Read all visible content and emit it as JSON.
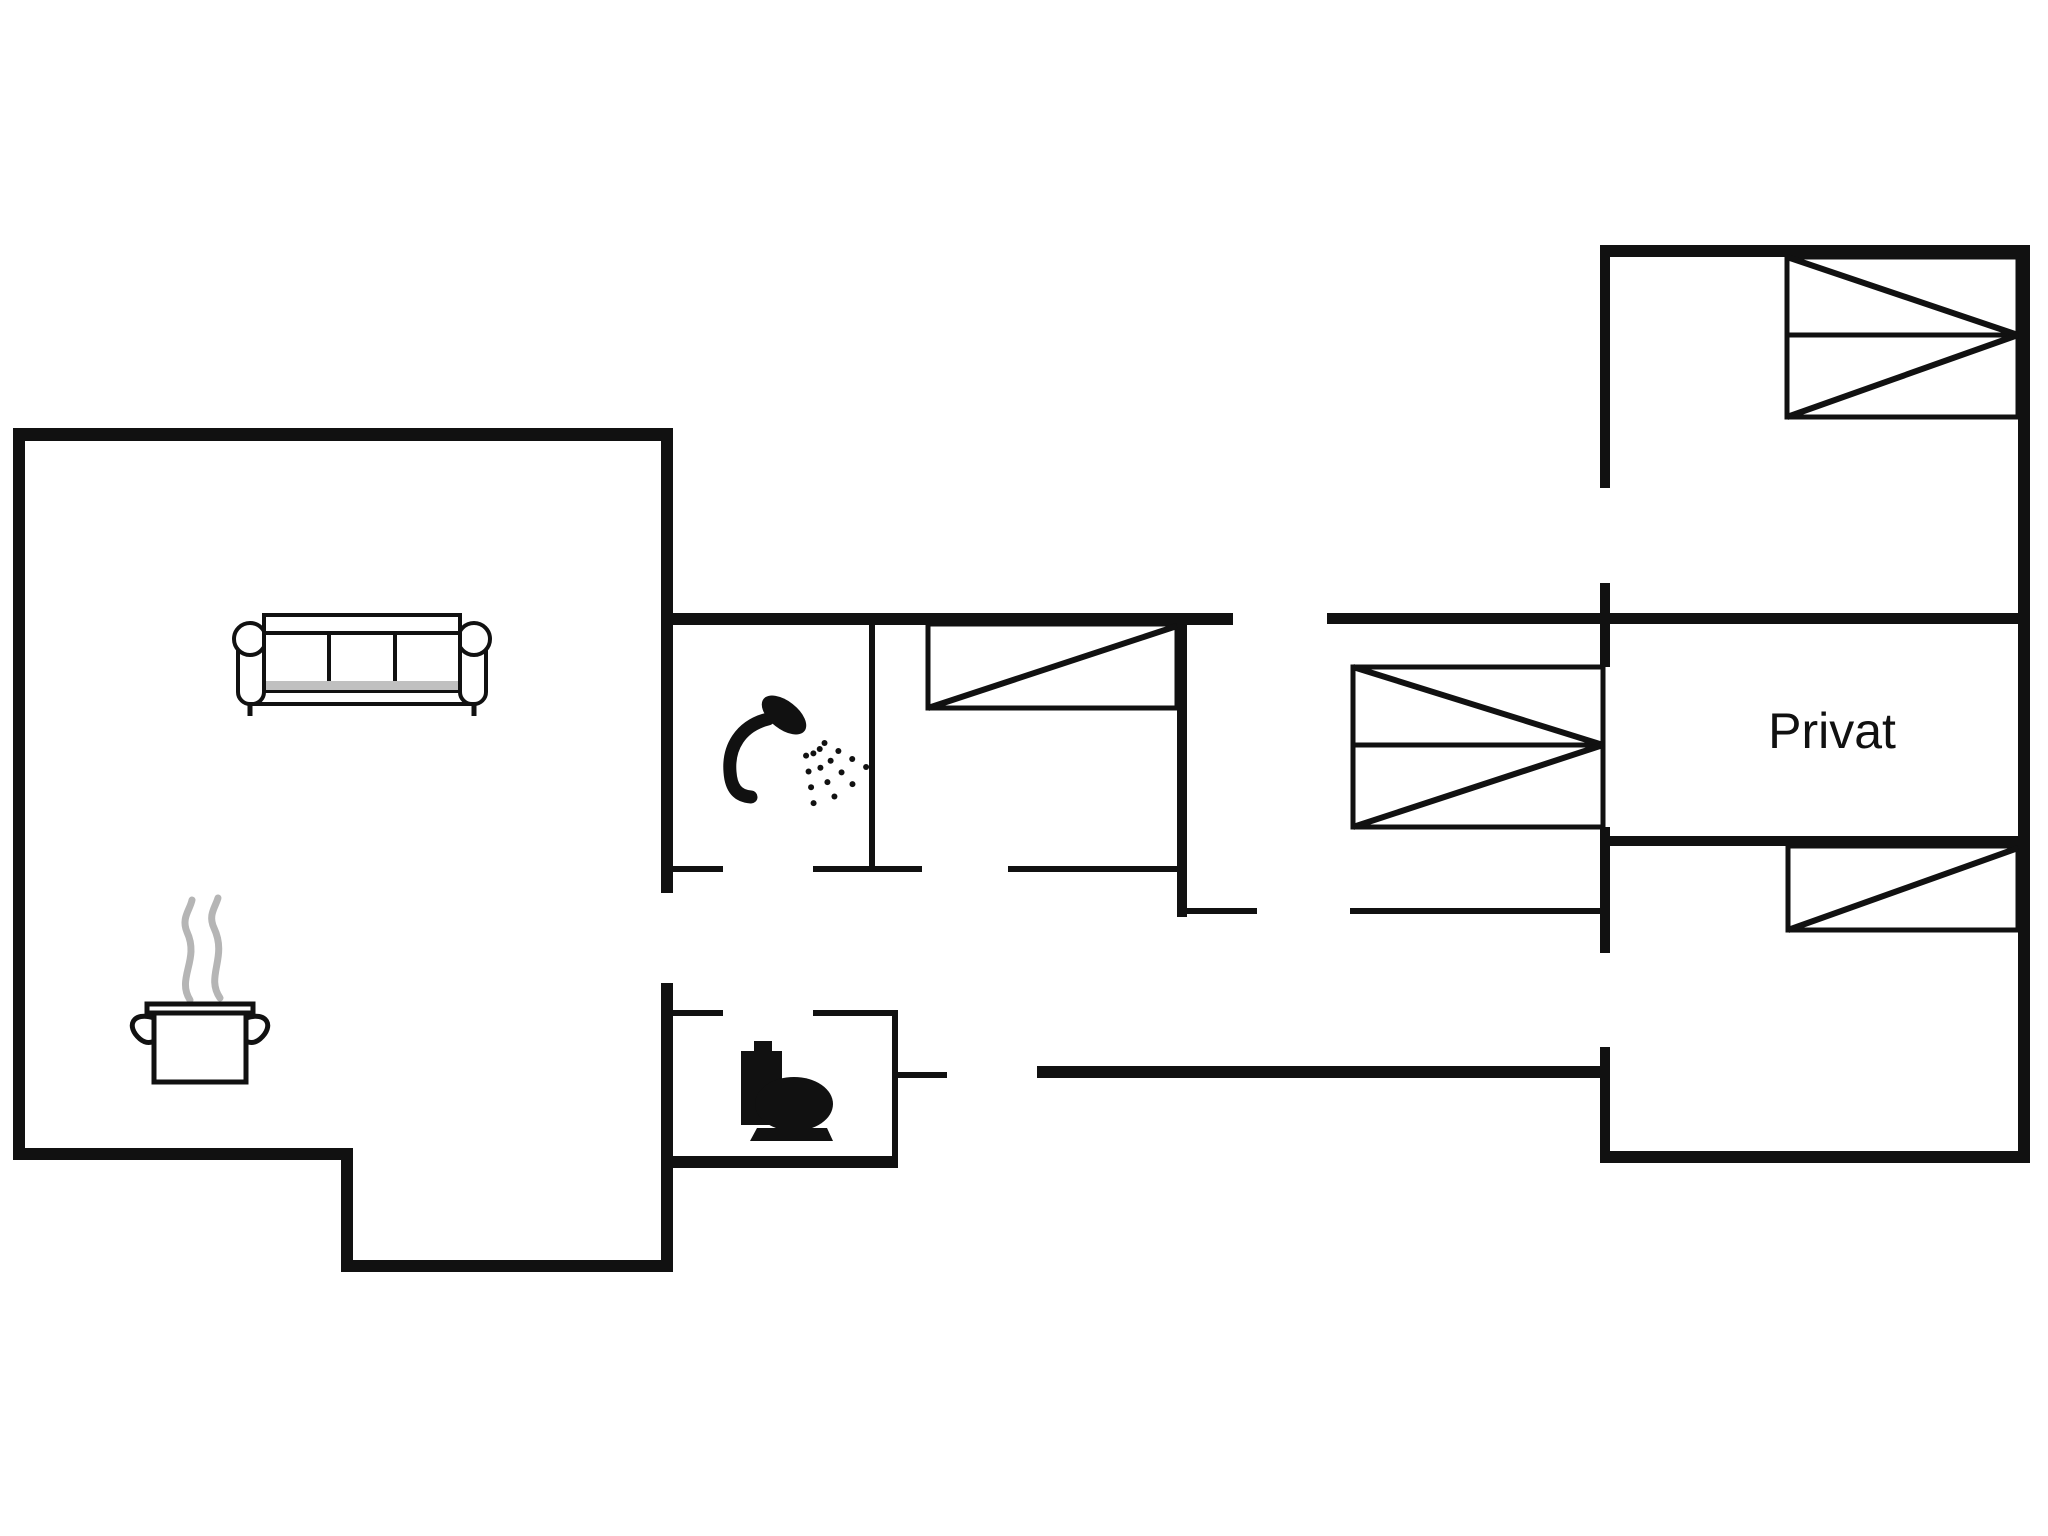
{
  "floorplan": {
    "canvas": {
      "width": 2048,
      "height": 1536,
      "background": "#ffffff"
    },
    "wall_color": "#111111",
    "steam_color": "#b5b5b5",
    "sofa_strip_color": "#c0c0c0",
    "label": {
      "text": "Privat",
      "x": 1832,
      "y": 748,
      "font_size": 50,
      "color": "#111111"
    },
    "walls": [
      {
        "x": 13,
        "y": 428,
        "w": 660,
        "h": 13
      },
      {
        "x": 13,
        "y": 428,
        "w": 12,
        "h": 732
      },
      {
        "x": 13,
        "y": 1148,
        "w": 340,
        "h": 12
      },
      {
        "x": 341,
        "y": 1148,
        "w": 12,
        "h": 124
      },
      {
        "x": 341,
        "y": 1260,
        "w": 332,
        "h": 12
      },
      {
        "x": 661,
        "y": 428,
        "w": 12,
        "h": 465
      },
      {
        "x": 661,
        "y": 983,
        "w": 12,
        "h": 289
      },
      {
        "x": 661,
        "y": 1010,
        "w": 62,
        "h": 6
      },
      {
        "x": 813,
        "y": 1010,
        "w": 85,
        "h": 6
      },
      {
        "x": 892,
        "y": 1010,
        "w": 6,
        "h": 158
      },
      {
        "x": 892,
        "y": 1072,
        "w": 55,
        "h": 6
      },
      {
        "x": 661,
        "y": 1156,
        "w": 237,
        "h": 12
      },
      {
        "x": 661,
        "y": 613,
        "w": 572,
        "h": 12
      },
      {
        "x": 1327,
        "y": 613,
        "w": 703,
        "h": 11
      },
      {
        "x": 869,
        "y": 613,
        "w": 6,
        "h": 259
      },
      {
        "x": 1177,
        "y": 613,
        "w": 10,
        "h": 304
      },
      {
        "x": 661,
        "y": 866,
        "w": 62,
        "h": 6
      },
      {
        "x": 813,
        "y": 866,
        "w": 109,
        "h": 6
      },
      {
        "x": 1008,
        "y": 866,
        "w": 175,
        "h": 6
      },
      {
        "x": 1177,
        "y": 908,
        "w": 80,
        "h": 6
      },
      {
        "x": 1350,
        "y": 908,
        "w": 256,
        "h": 6
      },
      {
        "x": 1037,
        "y": 1066,
        "w": 569,
        "h": 12
      },
      {
        "x": 1600,
        "y": 245,
        "w": 430,
        "h": 12
      },
      {
        "x": 2018,
        "y": 245,
        "w": 12,
        "h": 918
      },
      {
        "x": 1600,
        "y": 1151,
        "w": 430,
        "h": 12
      },
      {
        "x": 1600,
        "y": 245,
        "w": 10,
        "h": 243
      },
      {
        "x": 1600,
        "y": 583,
        "w": 10,
        "h": 84
      },
      {
        "x": 1600,
        "y": 827,
        "w": 10,
        "h": 126
      },
      {
        "x": 1600,
        "y": 1047,
        "w": 10,
        "h": 116
      },
      {
        "x": 1600,
        "y": 836,
        "w": 430,
        "h": 10
      }
    ],
    "openings": [
      {
        "name": "living-room-to-hall-door",
        "x": 667,
        "y": 893,
        "w": 6,
        "h": 90
      },
      {
        "name": "shower-room-door",
        "x": 723,
        "y": 866,
        "w": 90,
        "h": 6
      },
      {
        "name": "middle-bedroom-door",
        "x": 922,
        "y": 866,
        "w": 86,
        "h": 6
      },
      {
        "name": "toilet-room-door",
        "x": 723,
        "y": 1010,
        "w": 90,
        "h": 6
      },
      {
        "name": "entrance-door",
        "x": 947,
        "y": 1066,
        "w": 90,
        "h": 12
      },
      {
        "name": "hall-north-door",
        "x": 1233,
        "y": 613,
        "w": 94,
        "h": 12
      },
      {
        "name": "right-bedroom-door",
        "x": 1257,
        "y": 908,
        "w": 93,
        "h": 6
      },
      {
        "name": "right-wing-west-door",
        "x": 1600,
        "y": 488,
        "w": 10,
        "h": 95
      },
      {
        "name": "hall-to-right-wing-door",
        "x": 1600,
        "y": 953,
        "w": 10,
        "h": 94
      }
    ],
    "beds": [
      {
        "name": "bed-double-top-right",
        "x": 1787,
        "y": 257,
        "w": 231,
        "h": 160,
        "divider_y": 335,
        "diagonals": [
          [
            1787,
            257,
            2018,
            335
          ],
          [
            1787,
            417,
            2018,
            335
          ]
        ]
      },
      {
        "name": "bed-single-middle",
        "x": 928,
        "y": 624,
        "w": 249,
        "h": 84,
        "diagonals": [
          [
            928,
            708,
            1177,
            626
          ]
        ]
      },
      {
        "name": "bed-double-middle-right",
        "x": 1353,
        "y": 667,
        "w": 250,
        "h": 160,
        "divider_y": 745,
        "diagonals": [
          [
            1353,
            667,
            1603,
            745
          ],
          [
            1353,
            827,
            1603,
            745
          ]
        ]
      },
      {
        "name": "bed-single-bottom-right",
        "x": 1788,
        "y": 846,
        "w": 230,
        "h": 84,
        "diagonals": [
          [
            1788,
            930,
            2018,
            848
          ]
        ]
      }
    ],
    "icons": [
      {
        "name": "sofa-icon",
        "x": 236,
        "y": 615
      },
      {
        "name": "cooking-pot-icon",
        "x": 132,
        "y": 898
      },
      {
        "name": "shower-icon",
        "x": 725,
        "y": 695
      },
      {
        "name": "toilet-icon",
        "x": 741,
        "y": 1041
      }
    ],
    "shower_spray": {
      "origin_x": 802,
      "origin_y": 730,
      "angles": [
        30,
        47,
        64,
        81
      ],
      "radii": [
        26,
        42,
        58,
        74
      ],
      "dot_r": 3
    }
  }
}
